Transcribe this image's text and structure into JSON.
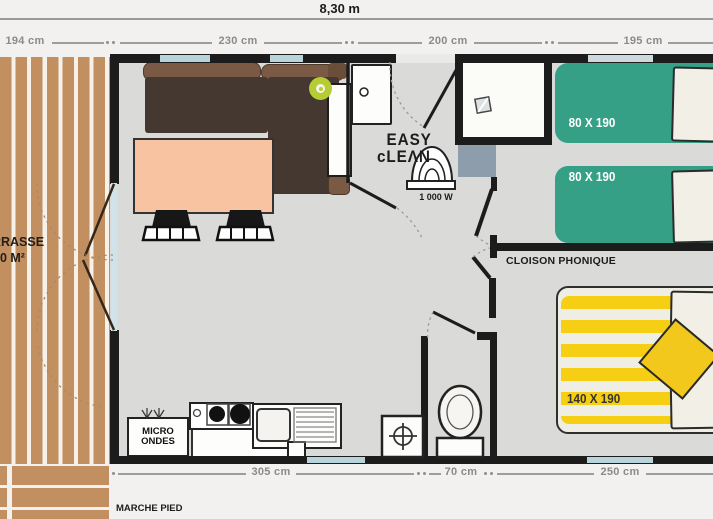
{
  "header": {
    "total_width_label": "8,30 m"
  },
  "dimensions": {
    "top": [
      "194 cm",
      "230 cm",
      "200 cm",
      "195 cm"
    ],
    "bottom": [
      "305 cm",
      "70 cm",
      "250 cm"
    ]
  },
  "terrace": {
    "name_line1": "TERRASSE",
    "name_line2": "30 M²",
    "steps_label": "MARCHE PIED"
  },
  "living": {
    "logo_line1": "EASY",
    "logo_line2": "cLEΛN",
    "heater_power": "1 000 W"
  },
  "kitchen": {
    "microwave_line1": "MICRO",
    "microwave_line2": "ONDES"
  },
  "bedrooms": {
    "partition_label": "CLOISON PHONIQUE",
    "single_bed_top": "80 X 190",
    "single_bed_bottom": "80 X 190",
    "double_bed": "140 X 190"
  },
  "colors": {
    "wall": "#1c1c1c",
    "floor": "#dadad8",
    "wood": "#c28f61",
    "window": "#b9d3da",
    "sofa_seat": "#453830",
    "sofa_back": "#7a5a45",
    "table": "#f8c3a0",
    "single_bed": "#35a086",
    "double_bed_stripe": "#f6ce14",
    "cushion_yellow": "#f3c81d",
    "shower_tray": "#8e9dab",
    "lime_accent": "#b5cc33"
  }
}
